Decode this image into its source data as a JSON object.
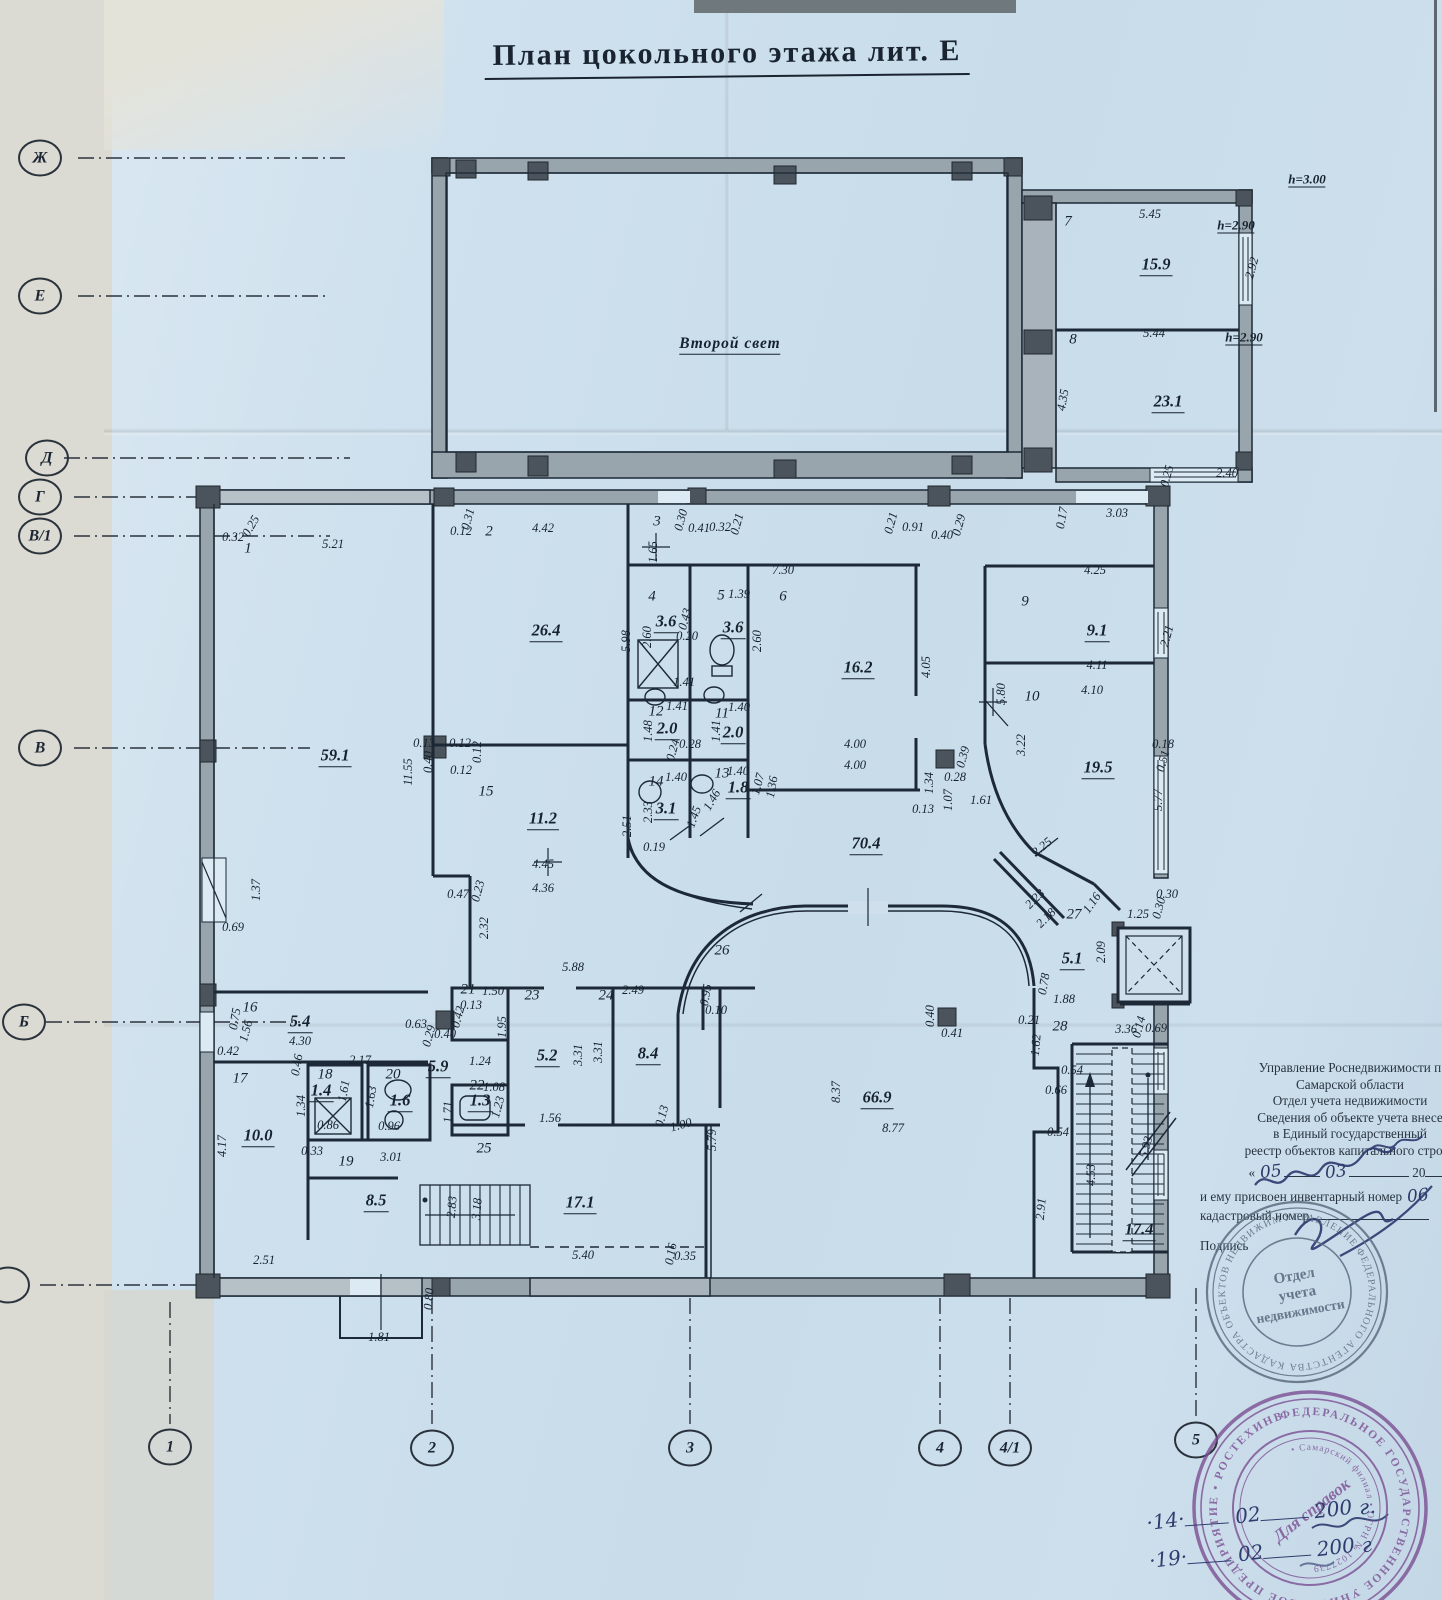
{
  "title": "План цокольного этажа лит. Е",
  "axes": {
    "left": [
      {
        "label": "Ж",
        "x": 40,
        "y": 158
      },
      {
        "label": "Е",
        "x": 40,
        "y": 296
      },
      {
        "label": "Д",
        "x": 47,
        "y": 458
      },
      {
        "label": "Г",
        "x": 40,
        "y": 497
      },
      {
        "label": "В/1",
        "x": 40,
        "y": 536
      },
      {
        "label": "В",
        "x": 40,
        "y": 748
      },
      {
        "label": "Б",
        "x": 24,
        "y": 1022
      },
      {
        "label": "",
        "x": 8,
        "y": 1285
      }
    ],
    "bottom": [
      {
        "label": "1",
        "x": 170,
        "y": 1447
      },
      {
        "label": "2",
        "x": 432,
        "y": 1448
      },
      {
        "label": "3",
        "x": 690,
        "y": 1448
      },
      {
        "label": "4",
        "x": 940,
        "y": 1448
      },
      {
        "label": "4/1",
        "x": 1010,
        "y": 1448
      },
      {
        "label": "5",
        "x": 1196,
        "y": 1440
      }
    ]
  },
  "plan_labels": [
    {
      "t": "Второй свет",
      "x": 730,
      "y": 345,
      "c": "t"
    },
    {
      "t": "h=3.00",
      "x": 1307,
      "y": 180,
      "c": "h"
    },
    {
      "t": "7",
      "x": 1068,
      "y": 222,
      "c": "n"
    },
    {
      "t": "5.45",
      "x": 1150,
      "y": 214,
      "c": "d"
    },
    {
      "t": "h=2.90",
      "x": 1236,
      "y": 226,
      "c": "h"
    },
    {
      "t": "15.9",
      "x": 1156,
      "y": 266,
      "c": "a"
    },
    {
      "t": "2.92",
      "x": 1252,
      "y": 268,
      "c": "d",
      "r": -75
    },
    {
      "t": "8",
      "x": 1073,
      "y": 340,
      "c": "n"
    },
    {
      "t": "5.44",
      "x": 1154,
      "y": 333,
      "c": "d"
    },
    {
      "t": "h=2.90",
      "x": 1244,
      "y": 338,
      "c": "h"
    },
    {
      "t": "23.1",
      "x": 1168,
      "y": 403,
      "c": "a"
    },
    {
      "t": "4.35",
      "x": 1063,
      "y": 400,
      "c": "d",
      "r": -80
    },
    {
      "t": "0.25",
      "x": 1167,
      "y": 476,
      "c": "d",
      "r": -75
    },
    {
      "t": "2.40",
      "x": 1227,
      "y": 473,
      "c": "d"
    },
    {
      "t": "3.03",
      "x": 1117,
      "y": 513,
      "c": "d"
    },
    {
      "t": "0.17",
      "x": 1062,
      "y": 518,
      "c": "d",
      "r": -80
    },
    {
      "t": "1",
      "x": 248,
      "y": 549,
      "c": "n"
    },
    {
      "t": "0.32",
      "x": 233,
      "y": 537,
      "c": "d"
    },
    {
      "t": "0.25",
      "x": 251,
      "y": 526,
      "c": "d",
      "r": -60
    },
    {
      "t": "5.21",
      "x": 333,
      "y": 544,
      "c": "d"
    },
    {
      "t": "0.12",
      "x": 461,
      "y": 531,
      "c": "d"
    },
    {
      "t": "2",
      "x": 489,
      "y": 532,
      "c": "n"
    },
    {
      "t": "0.31",
      "x": 468,
      "y": 519,
      "c": "d",
      "r": -75
    },
    {
      "t": "4.42",
      "x": 543,
      "y": 528,
      "c": "d"
    },
    {
      "t": "3",
      "x": 657,
      "y": 522,
      "c": "n"
    },
    {
      "t": "0.30",
      "x": 681,
      "y": 520,
      "c": "d",
      "r": -75
    },
    {
      "t": "0.41",
      "x": 699,
      "y": 528,
      "c": "d"
    },
    {
      "t": "0.32",
      "x": 720,
      "y": 527,
      "c": "d"
    },
    {
      "t": "0.21",
      "x": 737,
      "y": 524,
      "c": "d",
      "r": -75
    },
    {
      "t": "0.21",
      "x": 891,
      "y": 523,
      "c": "d",
      "r": -75
    },
    {
      "t": "0.91",
      "x": 913,
      "y": 527,
      "c": "d"
    },
    {
      "t": "0.40",
      "x": 942,
      "y": 535,
      "c": "d"
    },
    {
      "t": "0.29",
      "x": 959,
      "y": 525,
      "c": "d",
      "r": -75
    },
    {
      "t": "59.1",
      "x": 335,
      "y": 757,
      "c": "a"
    },
    {
      "t": "11.55",
      "x": 408,
      "y": 772,
      "c": "d",
      "r": -90
    },
    {
      "t": "1.37",
      "x": 256,
      "y": 890,
      "c": "d",
      "r": -90
    },
    {
      "t": "0.69",
      "x": 233,
      "y": 927,
      "c": "d"
    },
    {
      "t": "0.13",
      "x": 424,
      "y": 743,
      "c": "d"
    },
    {
      "t": "0.12",
      "x": 460,
      "y": 743,
      "c": "d"
    },
    {
      "t": "0.40",
      "x": 428,
      "y": 762,
      "c": "d",
      "r": -90
    },
    {
      "t": "0.12",
      "x": 477,
      "y": 752,
      "c": "d",
      "r": -90
    },
    {
      "t": "0.12",
      "x": 461,
      "y": 770,
      "c": "d"
    },
    {
      "t": "26.4",
      "x": 546,
      "y": 632,
      "c": "a"
    },
    {
      "t": "5.98",
      "x": 626,
      "y": 641,
      "c": "d",
      "r": -90
    },
    {
      "t": "15",
      "x": 486,
      "y": 792,
      "c": "n"
    },
    {
      "t": "11.2",
      "x": 543,
      "y": 820,
      "c": "a"
    },
    {
      "t": "2.51",
      "x": 627,
      "y": 826,
      "c": "d",
      "r": -90
    },
    {
      "t": "4.45",
      "x": 543,
      "y": 864,
      "c": "d"
    },
    {
      "t": "4.36",
      "x": 543,
      "y": 888,
      "c": "d"
    },
    {
      "t": "0.47",
      "x": 458,
      "y": 894,
      "c": "d"
    },
    {
      "t": "0.23",
      "x": 478,
      "y": 891,
      "c": "d",
      "r": -75
    },
    {
      "t": "2.32",
      "x": 484,
      "y": 928,
      "c": "d",
      "r": -90
    },
    {
      "t": "1.65",
      "x": 653,
      "y": 552,
      "c": "d",
      "r": -90
    },
    {
      "t": "4",
      "x": 652,
      "y": 597,
      "c": "n"
    },
    {
      "t": "3.6",
      "x": 666,
      "y": 623,
      "c": "a"
    },
    {
      "t": "0.43",
      "x": 685,
      "y": 619,
      "c": "d",
      "r": -75
    },
    {
      "t": "0.20",
      "x": 687,
      "y": 636,
      "c": "d"
    },
    {
      "t": "2.60",
      "x": 647,
      "y": 637,
      "c": "d",
      "r": -90
    },
    {
      "t": "1.41",
      "x": 684,
      "y": 682,
      "c": "d"
    },
    {
      "t": "5",
      "x": 721,
      "y": 596,
      "c": "n"
    },
    {
      "t": "1.39",
      "x": 739,
      "y": 594,
      "c": "d"
    },
    {
      "t": "3.6",
      "x": 733,
      "y": 629,
      "c": "a"
    },
    {
      "t": "2.60",
      "x": 757,
      "y": 641,
      "c": "d",
      "r": -90
    },
    {
      "t": "12",
      "x": 656,
      "y": 712,
      "c": "n"
    },
    {
      "t": "1.41",
      "x": 677,
      "y": 706,
      "c": "d"
    },
    {
      "t": "2.0",
      "x": 667,
      "y": 730,
      "c": "a"
    },
    {
      "t": "1.48",
      "x": 648,
      "y": 731,
      "c": "d",
      "r": -90
    },
    {
      "t": "0.24",
      "x": 673,
      "y": 750,
      "c": "d",
      "r": -75
    },
    {
      "t": "0.28",
      "x": 690,
      "y": 744,
      "c": "d"
    },
    {
      "t": "11",
      "x": 722,
      "y": 714,
      "c": "n"
    },
    {
      "t": "1.40",
      "x": 739,
      "y": 707,
      "c": "d"
    },
    {
      "t": "2.0",
      "x": 733,
      "y": 734,
      "c": "a"
    },
    {
      "t": "1.41",
      "x": 716,
      "y": 731,
      "c": "d",
      "r": -90
    },
    {
      "t": "14",
      "x": 656,
      "y": 782,
      "c": "n"
    },
    {
      "t": "1.40",
      "x": 676,
      "y": 777,
      "c": "d"
    },
    {
      "t": "3.1",
      "x": 666,
      "y": 810,
      "c": "a"
    },
    {
      "t": "2.33",
      "x": 648,
      "y": 812,
      "c": "d",
      "r": -90
    },
    {
      "t": "1.45",
      "x": 694,
      "y": 817,
      "c": "d",
      "r": -70
    },
    {
      "t": "13",
      "x": 722,
      "y": 774,
      "c": "n"
    },
    {
      "t": "1.40",
      "x": 738,
      "y": 771,
      "c": "d"
    },
    {
      "t": "1.8",
      "x": 738,
      "y": 789,
      "c": "a"
    },
    {
      "t": "1.07",
      "x": 758,
      "y": 784,
      "c": "d",
      "r": -75
    },
    {
      "t": "1.46",
      "x": 712,
      "y": 800,
      "c": "d",
      "r": -60
    },
    {
      "t": "0.19",
      "x": 654,
      "y": 847,
      "c": "d"
    },
    {
      "t": "1.36",
      "x": 772,
      "y": 787,
      "c": "d",
      "r": -80
    },
    {
      "t": "6",
      "x": 783,
      "y": 597,
      "c": "n"
    },
    {
      "t": "7.30",
      "x": 783,
      "y": 570,
      "c": "d"
    },
    {
      "t": "16.2",
      "x": 858,
      "y": 669,
      "c": "a"
    },
    {
      "t": "4.05",
      "x": 926,
      "y": 667,
      "c": "d",
      "r": -90
    },
    {
      "t": "4.00",
      "x": 855,
      "y": 744,
      "c": "d"
    },
    {
      "t": "4.00",
      "x": 855,
      "y": 765,
      "c": "d"
    },
    {
      "t": "1.34",
      "x": 929,
      "y": 783,
      "c": "d",
      "r": -90
    },
    {
      "t": "1.07",
      "x": 948,
      "y": 800,
      "c": "d",
      "r": -90
    },
    {
      "t": "0.13",
      "x": 923,
      "y": 809,
      "c": "d"
    },
    {
      "t": "0.28",
      "x": 955,
      "y": 777,
      "c": "d"
    },
    {
      "t": "0.39",
      "x": 963,
      "y": 757,
      "c": "d",
      "r": -75
    },
    {
      "t": "1.61",
      "x": 981,
      "y": 800,
      "c": "d"
    },
    {
      "t": "9",
      "x": 1025,
      "y": 602,
      "c": "n"
    },
    {
      "t": "4.25",
      "x": 1095,
      "y": 570,
      "c": "d"
    },
    {
      "t": "9.1",
      "x": 1097,
      "y": 632,
      "c": "a"
    },
    {
      "t": "2.21",
      "x": 1167,
      "y": 636,
      "c": "d",
      "r": -75
    },
    {
      "t": "4.11",
      "x": 1097,
      "y": 665,
      "c": "d"
    },
    {
      "t": "10",
      "x": 1032,
      "y": 697,
      "c": "n"
    },
    {
      "t": "4.10",
      "x": 1092,
      "y": 690,
      "c": "d"
    },
    {
      "t": "5.80",
      "x": 1001,
      "y": 694,
      "c": "d",
      "r": -90
    },
    {
      "t": "3.22",
      "x": 1021,
      "y": 745,
      "c": "d",
      "r": -90
    },
    {
      "t": "19.5",
      "x": 1098,
      "y": 769,
      "c": "a"
    },
    {
      "t": "0.18",
      "x": 1163,
      "y": 744,
      "c": "d"
    },
    {
      "t": "0.51",
      "x": 1163,
      "y": 761,
      "c": "d",
      "r": -75
    },
    {
      "t": "5.77",
      "x": 1158,
      "y": 800,
      "c": "d",
      "r": -90
    },
    {
      "t": "70.4",
      "x": 866,
      "y": 845,
      "c": "a"
    },
    {
      "t": "26",
      "x": 722,
      "y": 951,
      "c": "n"
    },
    {
      "t": "5.88",
      "x": 573,
      "y": 967,
      "c": "d"
    },
    {
      "t": "2.49",
      "x": 633,
      "y": 990,
      "c": "d"
    },
    {
      "t": "0.95",
      "x": 706,
      "y": 995,
      "c": "d",
      "r": -80
    },
    {
      "t": "0.10",
      "x": 716,
      "y": 1010,
      "c": "d"
    },
    {
      "t": "2.25",
      "x": 1042,
      "y": 847,
      "c": "d",
      "r": -40
    },
    {
      "t": "27",
      "x": 1074,
      "y": 915,
      "c": "n"
    },
    {
      "t": "2.23",
      "x": 1035,
      "y": 899,
      "c": "d",
      "r": -45
    },
    {
      "t": "2.18",
      "x": 1046,
      "y": 918,
      "c": "d",
      "r": -45
    },
    {
      "t": "1.16",
      "x": 1092,
      "y": 903,
      "c": "d",
      "r": -55
    },
    {
      "t": "5.1",
      "x": 1072,
      "y": 960,
      "c": "a"
    },
    {
      "t": "2.09",
      "x": 1101,
      "y": 952,
      "c": "d",
      "r": -90
    },
    {
      "t": "0.78",
      "x": 1044,
      "y": 984,
      "c": "d",
      "r": -80
    },
    {
      "t": "1.25",
      "x": 1138,
      "y": 914,
      "c": "d"
    },
    {
      "t": "0.30",
      "x": 1159,
      "y": 908,
      "c": "d",
      "r": -75
    },
    {
      "t": "0.30",
      "x": 1167,
      "y": 894,
      "c": "d"
    },
    {
      "t": "0.40",
      "x": 930,
      "y": 1016,
      "c": "d",
      "r": -90
    },
    {
      "t": "0.41",
      "x": 952,
      "y": 1033,
      "c": "d"
    },
    {
      "t": "66.9",
      "x": 877,
      "y": 1099,
      "c": "a"
    },
    {
      "t": "8.37",
      "x": 836,
      "y": 1092,
      "c": "d",
      "r": -90
    },
    {
      "t": "8.77",
      "x": 893,
      "y": 1128,
      "c": "d"
    },
    {
      "t": "28",
      "x": 1060,
      "y": 1027,
      "c": "n"
    },
    {
      "t": "1.88",
      "x": 1064,
      "y": 999,
      "c": "d"
    },
    {
      "t": "0.21",
      "x": 1029,
      "y": 1020,
      "c": "d"
    },
    {
      "t": "1.62",
      "x": 1036,
      "y": 1045,
      "c": "d",
      "r": -85
    },
    {
      "t": "3.36",
      "x": 1126,
      "y": 1029,
      "c": "d"
    },
    {
      "t": "0.14",
      "x": 1139,
      "y": 1027,
      "c": "d",
      "r": -75
    },
    {
      "t": "0.69",
      "x": 1156,
      "y": 1028,
      "c": "d"
    },
    {
      "t": "0.54",
      "x": 1072,
      "y": 1070,
      "c": "d"
    },
    {
      "t": "0.66",
      "x": 1056,
      "y": 1090,
      "c": "d"
    },
    {
      "t": "0.54",
      "x": 1058,
      "y": 1132,
      "c": "d"
    },
    {
      "t": "2.91",
      "x": 1041,
      "y": 1209,
      "c": "d",
      "r": -85
    },
    {
      "t": "4.53",
      "x": 1091,
      "y": 1175,
      "c": "d",
      "r": -90
    },
    {
      "t": "5.93",
      "x": 1146,
      "y": 1147,
      "c": "d",
      "r": -75
    },
    {
      "t": "17.4",
      "x": 1139,
      "y": 1231,
      "c": "a"
    },
    {
      "t": "16",
      "x": 250,
      "y": 1008,
      "c": "n"
    },
    {
      "t": "0.75",
      "x": 235,
      "y": 1019,
      "c": "d",
      "r": -80
    },
    {
      "t": "1.56",
      "x": 246,
      "y": 1031,
      "c": "d",
      "r": -75
    },
    {
      "t": "0.42",
      "x": 228,
      "y": 1051,
      "c": "d"
    },
    {
      "t": "5.4",
      "x": 300,
      "y": 1023,
      "c": "a"
    },
    {
      "t": "4.30",
      "x": 300,
      "y": 1041,
      "c": "d"
    },
    {
      "t": "0.46",
      "x": 297,
      "y": 1065,
      "c": "d",
      "r": -80
    },
    {
      "t": "2.17",
      "x": 360,
      "y": 1060,
      "c": "d"
    },
    {
      "t": "17",
      "x": 240,
      "y": 1079,
      "c": "n"
    },
    {
      "t": "10.0",
      "x": 258,
      "y": 1137,
      "c": "a"
    },
    {
      "t": "4.17",
      "x": 222,
      "y": 1146,
      "c": "d",
      "r": -90
    },
    {
      "t": "2.51",
      "x": 264,
      "y": 1260,
      "c": "d"
    },
    {
      "t": "1.34",
      "x": 301,
      "y": 1106,
      "c": "d",
      "r": -90
    },
    {
      "t": "18",
      "x": 325,
      "y": 1075,
      "c": "n"
    },
    {
      "t": "1.4",
      "x": 321,
      "y": 1092,
      "c": "a"
    },
    {
      "t": "1.61",
      "x": 344,
      "y": 1091,
      "c": "d",
      "r": -80
    },
    {
      "t": "0.86",
      "x": 328,
      "y": 1125,
      "c": "d"
    },
    {
      "t": "20",
      "x": 393,
      "y": 1075,
      "c": "n"
    },
    {
      "t": "1.6",
      "x": 400,
      "y": 1102,
      "c": "a"
    },
    {
      "t": "1.63",
      "x": 371,
      "y": 1097,
      "c": "d",
      "r": -80
    },
    {
      "t": "0.96",
      "x": 389,
      "y": 1126,
      "c": "d"
    },
    {
      "t": "0.33",
      "x": 312,
      "y": 1151,
      "c": "d"
    },
    {
      "t": "19",
      "x": 346,
      "y": 1162,
      "c": "n"
    },
    {
      "t": "3.01",
      "x": 391,
      "y": 1157,
      "c": "d"
    },
    {
      "t": "8.5",
      "x": 376,
      "y": 1202,
      "c": "a"
    },
    {
      "t": "2.83",
      "x": 452,
      "y": 1207,
      "c": "d",
      "r": -85
    },
    {
      "t": "3.18",
      "x": 477,
      "y": 1209,
      "c": "d",
      "r": -85
    },
    {
      "t": "1.81",
      "x": 379,
      "y": 1337,
      "c": "d"
    },
    {
      "t": "0.80",
      "x": 429,
      "y": 1299,
      "c": "d",
      "r": -85
    },
    {
      "t": "0.63",
      "x": 416,
      "y": 1024,
      "c": "d"
    },
    {
      "t": "0.29",
      "x": 429,
      "y": 1036,
      "c": "d",
      "r": -75
    },
    {
      "t": "0.40",
      "x": 445,
      "y": 1034,
      "c": "d"
    },
    {
      "t": "5.9",
      "x": 438,
      "y": 1068,
      "c": "a"
    },
    {
      "t": "21",
      "x": 468,
      "y": 990,
      "c": "n"
    },
    {
      "t": "1.50",
      "x": 493,
      "y": 991,
      "c": "d"
    },
    {
      "t": "0.13",
      "x": 471,
      "y": 1005,
      "c": "d"
    },
    {
      "t": "0.42",
      "x": 458,
      "y": 1017,
      "c": "d",
      "r": -75
    },
    {
      "t": "1.95",
      "x": 502,
      "y": 1027,
      "c": "d",
      "r": -90
    },
    {
      "t": "23",
      "x": 532,
      "y": 996,
      "c": "n"
    },
    {
      "t": "5.2",
      "x": 547,
      "y": 1057,
      "c": "a"
    },
    {
      "t": "3.31",
      "x": 578,
      "y": 1055,
      "c": "d",
      "r": -90
    },
    {
      "t": "1.56",
      "x": 550,
      "y": 1118,
      "c": "d"
    },
    {
      "t": "24",
      "x": 606,
      "y": 996,
      "c": "n"
    },
    {
      "t": "8.4",
      "x": 648,
      "y": 1055,
      "c": "a"
    },
    {
      "t": "3.31",
      "x": 598,
      "y": 1052,
      "c": "d",
      "r": -90
    },
    {
      "t": "0.13",
      "x": 662,
      "y": 1116,
      "c": "d",
      "r": -75
    },
    {
      "t": "1.00",
      "x": 681,
      "y": 1125,
      "c": "d",
      "r": -15
    },
    {
      "t": "22",
      "x": 477,
      "y": 1086,
      "c": "n"
    },
    {
      "t": "1.08",
      "x": 494,
      "y": 1087,
      "c": "d"
    },
    {
      "t": "1.3",
      "x": 480,
      "y": 1102,
      "c": "a"
    },
    {
      "t": "1.23",
      "x": 498,
      "y": 1107,
      "c": "d",
      "r": -75
    },
    {
      "t": "1.71",
      "x": 448,
      "y": 1112,
      "c": "d",
      "r": -90
    },
    {
      "t": "1.24",
      "x": 480,
      "y": 1061,
      "c": "d"
    },
    {
      "t": "25",
      "x": 484,
      "y": 1149,
      "c": "n"
    },
    {
      "t": "17.1",
      "x": 580,
      "y": 1204,
      "c": "a"
    },
    {
      "t": "5.40",
      "x": 583,
      "y": 1255,
      "c": "d"
    },
    {
      "t": "0.16",
      "x": 671,
      "y": 1254,
      "c": "d",
      "r": -80
    },
    {
      "t": "0.35",
      "x": 685,
      "y": 1256,
      "c": "d"
    },
    {
      "t": "5.79",
      "x": 712,
      "y": 1140,
      "c": "d",
      "r": -90
    }
  ],
  "office_note": {
    "lines": [
      "Управление Роснедвижимости п",
      "Самарской области",
      "Отдел учета недвижимости",
      "Сведения об объекте учета внесе",
      "в Единый государственный",
      "реестр объектов капитального строит"
    ],
    "quote_open": "«",
    "hw_day": "05",
    "hw_month": "03",
    "century": "20",
    "line_inv": "и ему присвоен инвентарный номер",
    "hw_inv": "06",
    "line_kad": "кадастровый номер",
    "line_sign": "Подпись"
  },
  "round_stamp": {
    "ring": "УПРАВЛЕНИЕ ФЕДЕРАЛЬНОГО АГЕНТСТВА КАДАСТРА ОБЪЕКТОВ НЕДВИЖИМОСТИ • ПО САМАРСКОЙ ОБЛАСТИ •",
    "center": [
      "Отдел",
      "учета",
      "недвижимости"
    ]
  },
  "purple_stamp": {
    "ring_outer": "ФЕДЕРАЛЬНОЕ ГОСУДАРСТВЕННОЕ УНИТАРНОЕ ПРЕДПРИЯТИЕ • РОСТЕХИНВЕНТАРИЗАЦИЯ •",
    "ring_inner": "• Самарский филиал • ОГРН № 1027739",
    "center": "Для справок"
  },
  "dates": [
    {
      "d": "·14·",
      "m": "02",
      "y": "200",
      "suffix": "г."
    },
    {
      "d": "·19·",
      "m": "02",
      "y": "200",
      "suffix": "г"
    }
  ]
}
